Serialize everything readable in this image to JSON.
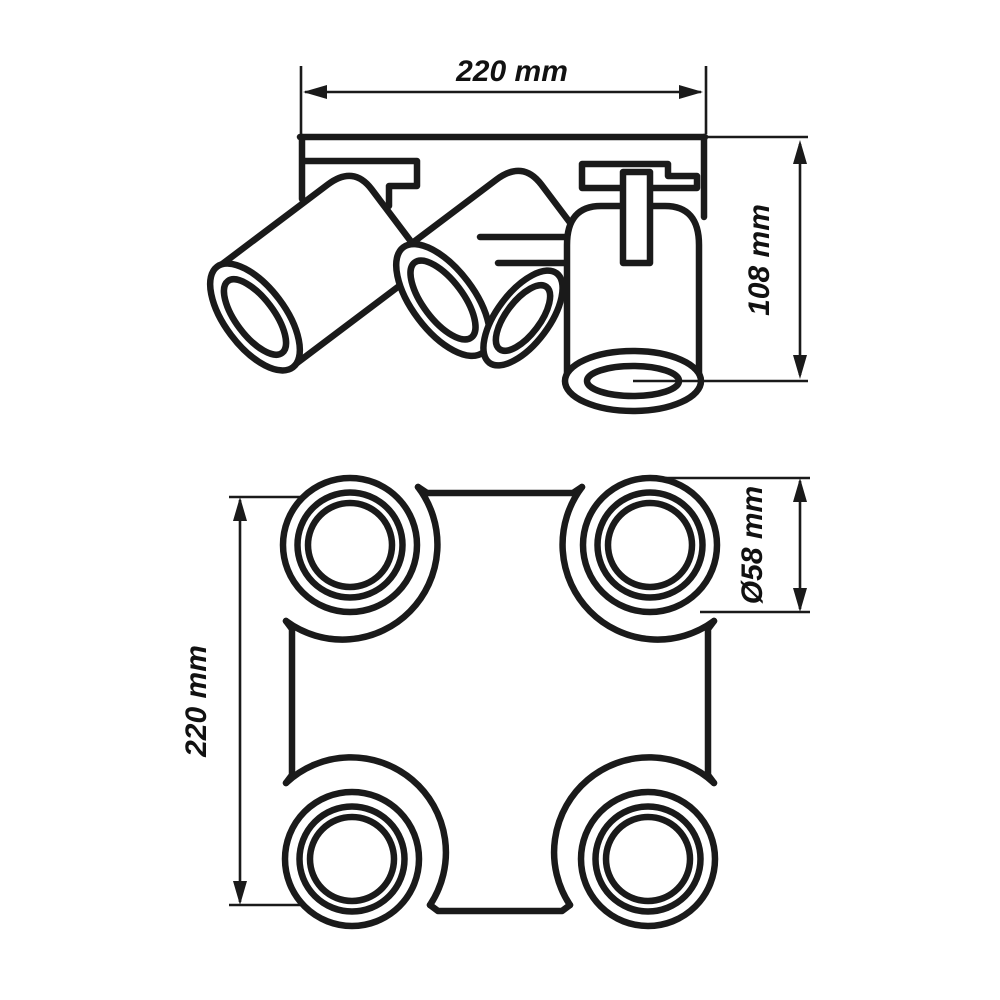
{
  "colors": {
    "background": "#ffffff",
    "line": "#1a1a1a"
  },
  "side_view": {
    "width_label": "220 mm",
    "height_label": "108 mm"
  },
  "bottom_view": {
    "height_label": "220 mm",
    "diameter_label": "Ø58 mm"
  }
}
